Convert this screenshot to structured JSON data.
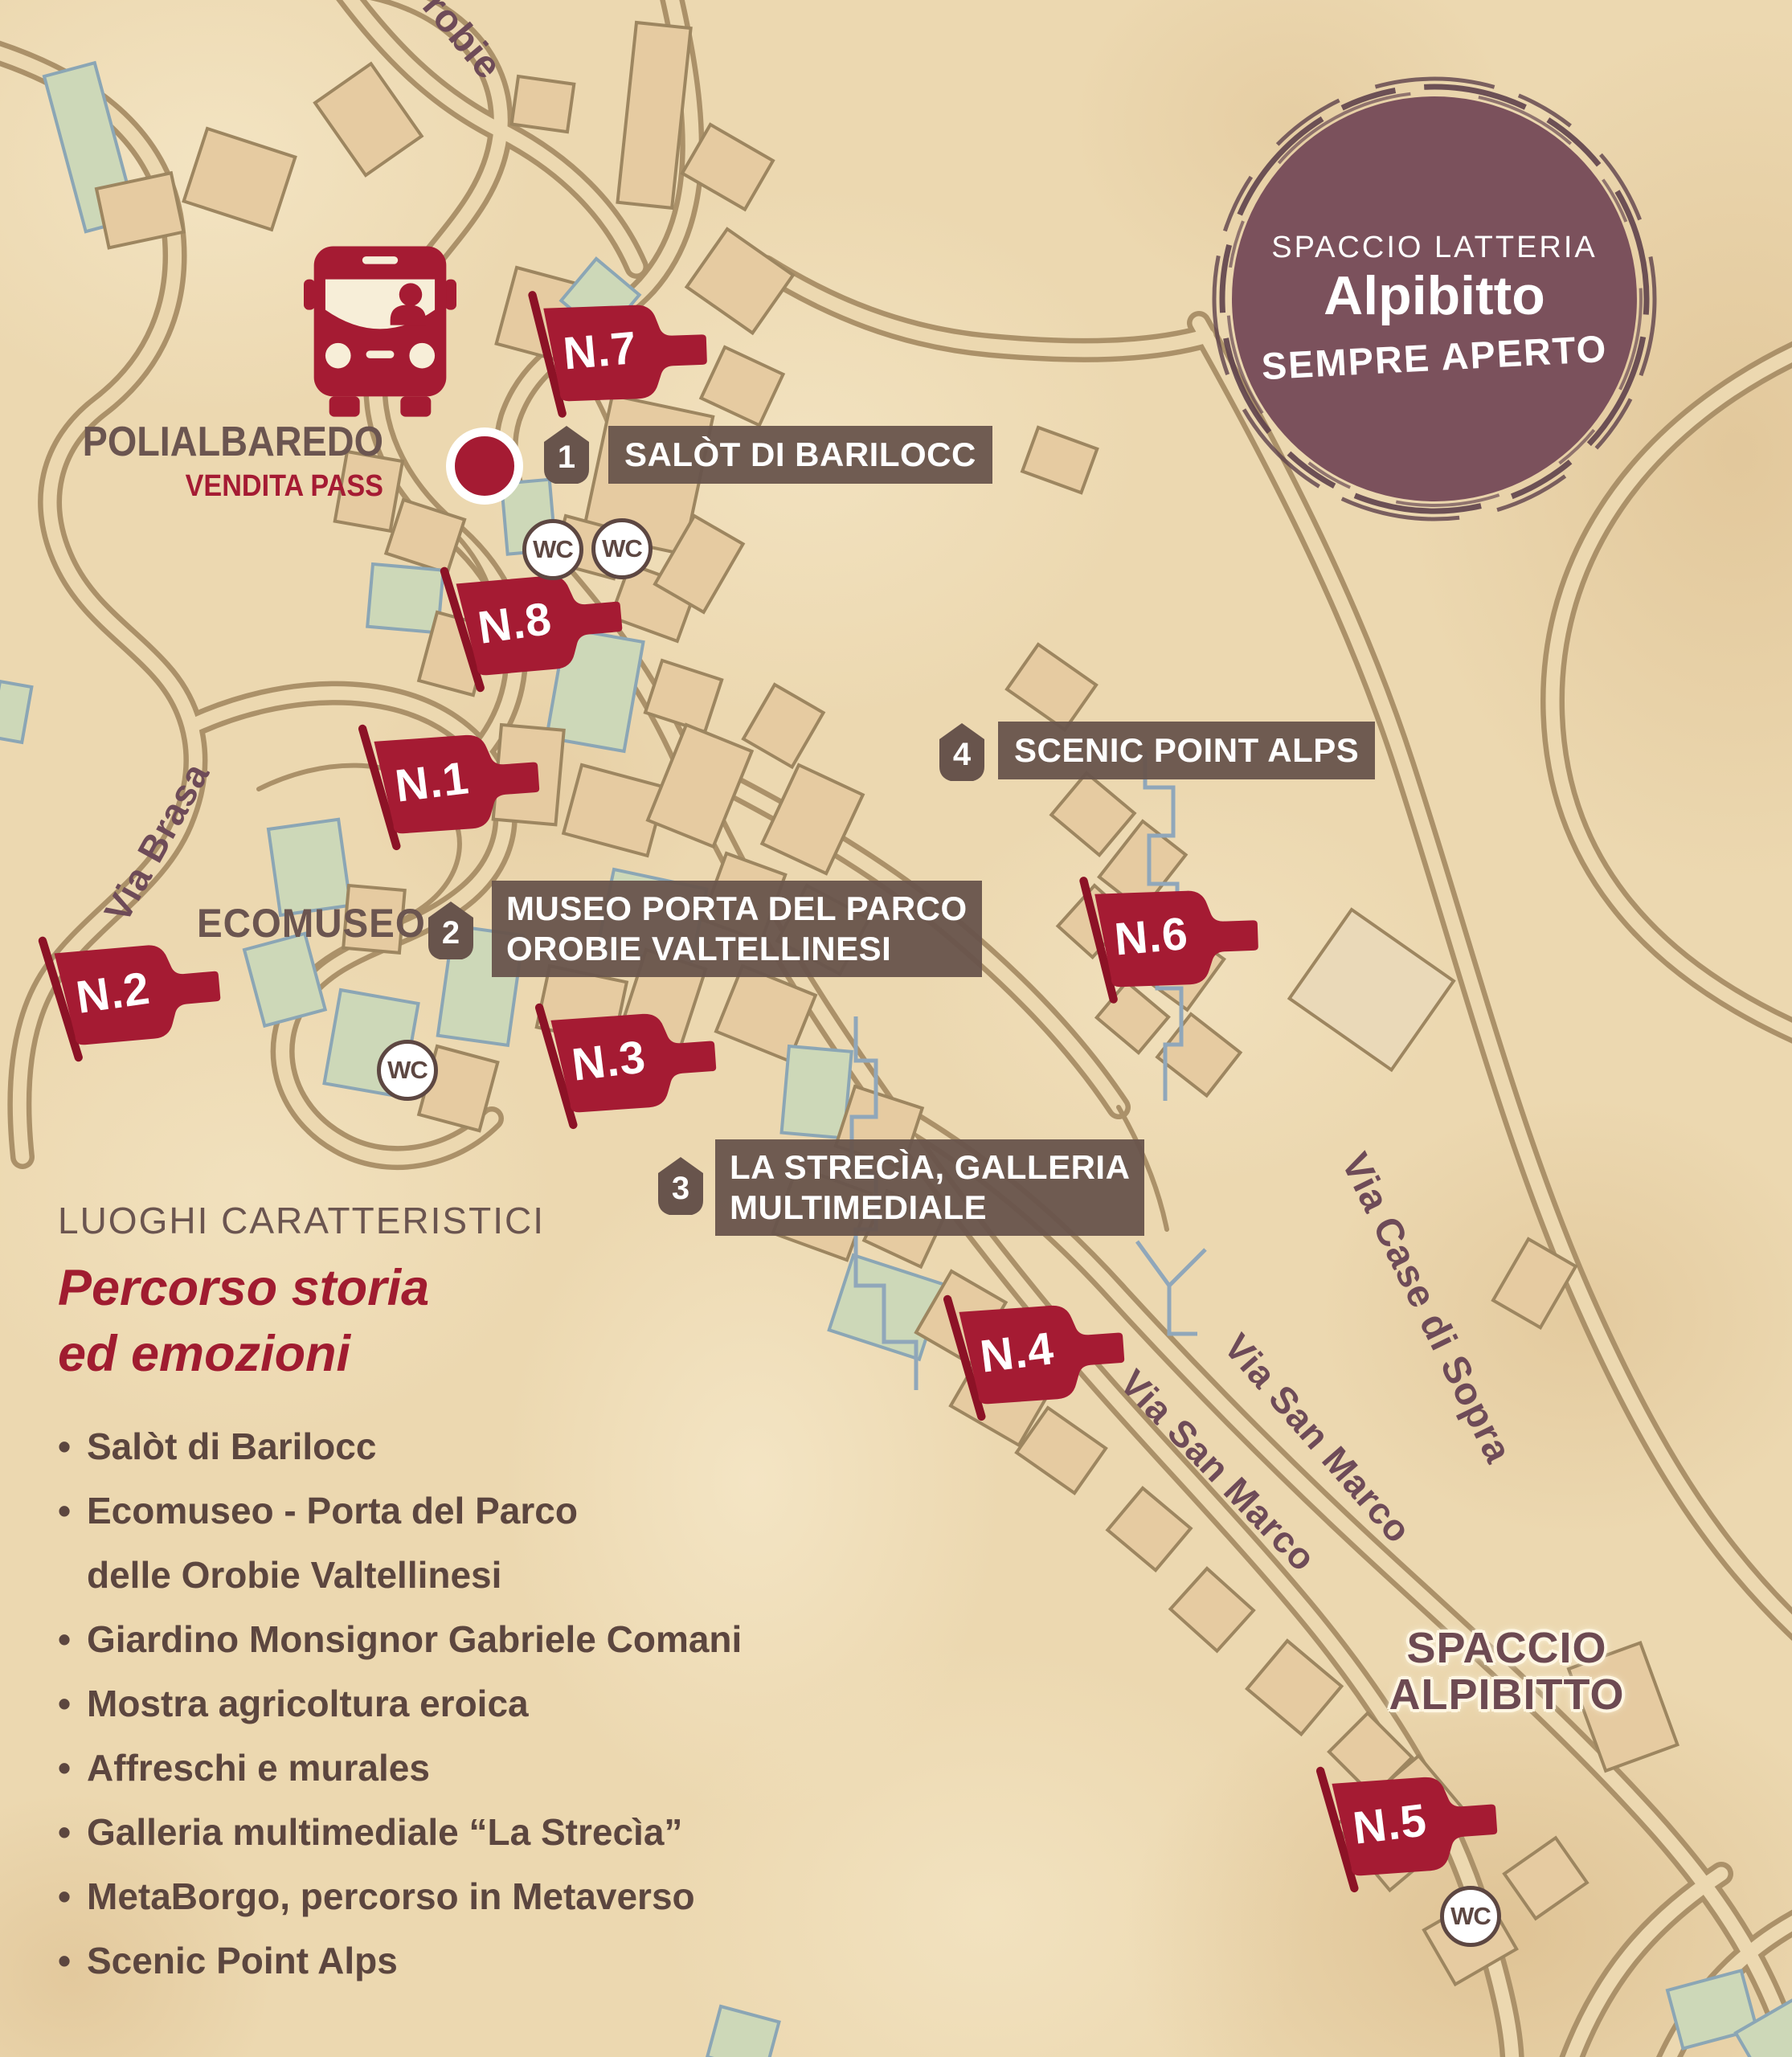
{
  "badge": {
    "top": "SPACCIO LATTERIA",
    "name": "Alpibitto",
    "bottom": "SEMPRE APERTO"
  },
  "bus_stop": {
    "name": "POLIALBAREDO",
    "subtitle": "VENDITA PASS"
  },
  "flags": {
    "n1": "N.1",
    "n2": "N.2",
    "n3": "N.3",
    "n4": "N.4",
    "n5": "N.5",
    "n6": "N.6",
    "n7": "N.7",
    "n8": "N.8"
  },
  "markers": {
    "m1": {
      "number": "1",
      "line1": "SALÒT DI BARILOCC"
    },
    "m2": {
      "number": "2",
      "line1": "MUSEO PORTA DEL PARCO",
      "line2": "OROBIE VALTELLINESI"
    },
    "m3": {
      "number": "3",
      "line1": "LA STRECÌA, GALLERIA",
      "line2": "MULTIMEDIALE"
    },
    "m4": {
      "number": "4",
      "line1": "SCENIC POINT ALPS"
    }
  },
  "streets": {
    "partial_top": "robie",
    "via_brasa": "Via Brasa",
    "via_san_marco_1": "Via San Marco",
    "via_san_marco_2": "Via San Marco",
    "via_case_di_sopra": "Via Case di Sopra"
  },
  "places": {
    "ecomuseo": "ECOMUSEO",
    "spaccio_line1": "SPACCIO",
    "spaccio_line2": "ALPIBITTO"
  },
  "wc_label": "WC",
  "legend": {
    "title": "LUOGHI CARATTERISTICI",
    "subtitle_line1": "Percorso storia",
    "subtitle_line2": "ed emozioni",
    "items": [
      {
        "bullet": true,
        "text": "Salòt di Barilocc"
      },
      {
        "bullet": true,
        "text": "Ecomuseo - Porta del Parco"
      },
      {
        "bullet": false,
        "text": "delle Orobie Valtellinesi"
      },
      {
        "bullet": true,
        "text": "Giardino Monsignor Gabriele Comani"
      },
      {
        "bullet": true,
        "text": "Mostra agricoltura eroica"
      },
      {
        "bullet": true,
        "text": "Affreschi e murales"
      },
      {
        "bullet": true,
        "text": "Galleria multimediale “La Strecìa”"
      },
      {
        "bullet": true,
        "text": "MetaBorgo, percorso in Metaverso"
      },
      {
        "bullet": true,
        "text": "Scenic Point Alps"
      }
    ]
  },
  "colors": {
    "flag_red": "#a51b33",
    "label_box_brown": "#68544c",
    "badge_mauve": "#7b515c",
    "street_text": "#6e4b58",
    "map_text_brown": "#6b5550",
    "list_text": "#5c463f",
    "road": "#ab9169",
    "trail_blue": "#90a7ba",
    "parchment": "#ecd8b0"
  }
}
